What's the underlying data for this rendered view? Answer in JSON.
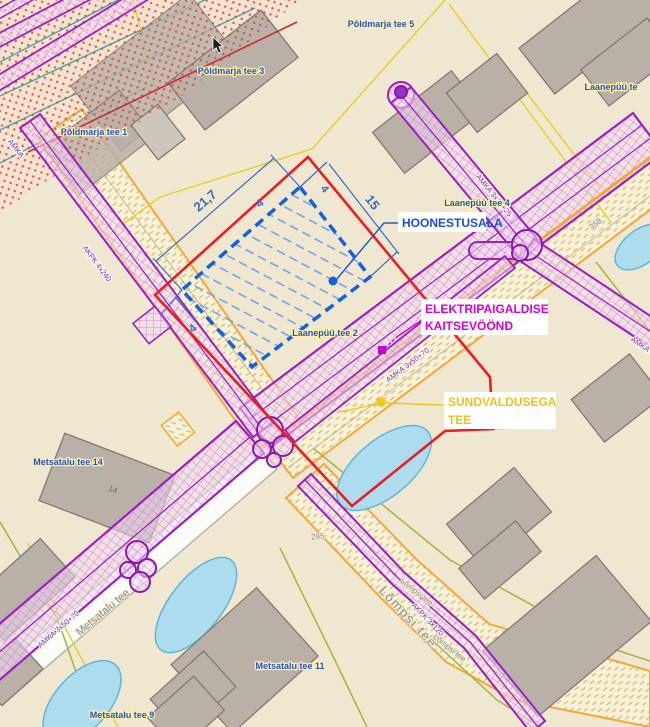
{
  "map": {
    "annotations": {
      "hoonestusala": "HOONESTUSALA",
      "kaitsevoond_line1": "ELEKTRIPAIGALDISE",
      "kaitsevoond_line2": "KAITSEVÖÖND",
      "sundvaldus_line1": "SUNDVALDUSEGA",
      "sundvaldus_line2": "TEE"
    },
    "dimensions": {
      "width": "21,7",
      "depth": "15",
      "offset_top": "4",
      "offset_right": "4",
      "offset_left": "4"
    },
    "street_labels": {
      "poldmarja_5": "Põldmarja tee 5",
      "poldmarja_3": "Põldmarja tee 3",
      "poldmarja_1": "Põldmarja tee 1",
      "laanepuu_4": "Laanepüü tee 4",
      "laanepuu_clipped": "Laanepüü te",
      "laanepuu_2": "Laanepüü tee 2",
      "metsatalu_14": "Metsatalu tee 14",
      "metsatalu_11": "Metsatalu tee 11",
      "metsatalu_9": "Metsatalu tee 9"
    },
    "road_labels": {
      "metsatalu": "Metsatalu tee",
      "lompsi_large": "Lõmpsi tee",
      "lompsi_small": "Lõmpsi tee",
      "lompsi_orange": "Lõmpsi tee",
      "road_number": "358",
      "parcel_number": "295",
      "house_number": "14"
    },
    "cable_labels": {
      "amka_16_25": "AMKA 3x16+25",
      "amka_50_70_a": "AMKA 3x50+70",
      "amka_50_70_b": "AMKA 3x50+70",
      "akpk_4x240": "AKPK 4x240",
      "akpk_3x120": "AKPK 3x120",
      "amka_clipped": "AMKA 3x",
      "amka_corner": "AMKA"
    },
    "colors": {
      "hoonestusala_accent": "#1660d8",
      "kaitsevoond_accent": "#d400d4",
      "sundvaldus_accent": "#f3c613",
      "boundary_red": "#ed1c24",
      "corridor_purple": "#9c1fc1"
    }
  }
}
